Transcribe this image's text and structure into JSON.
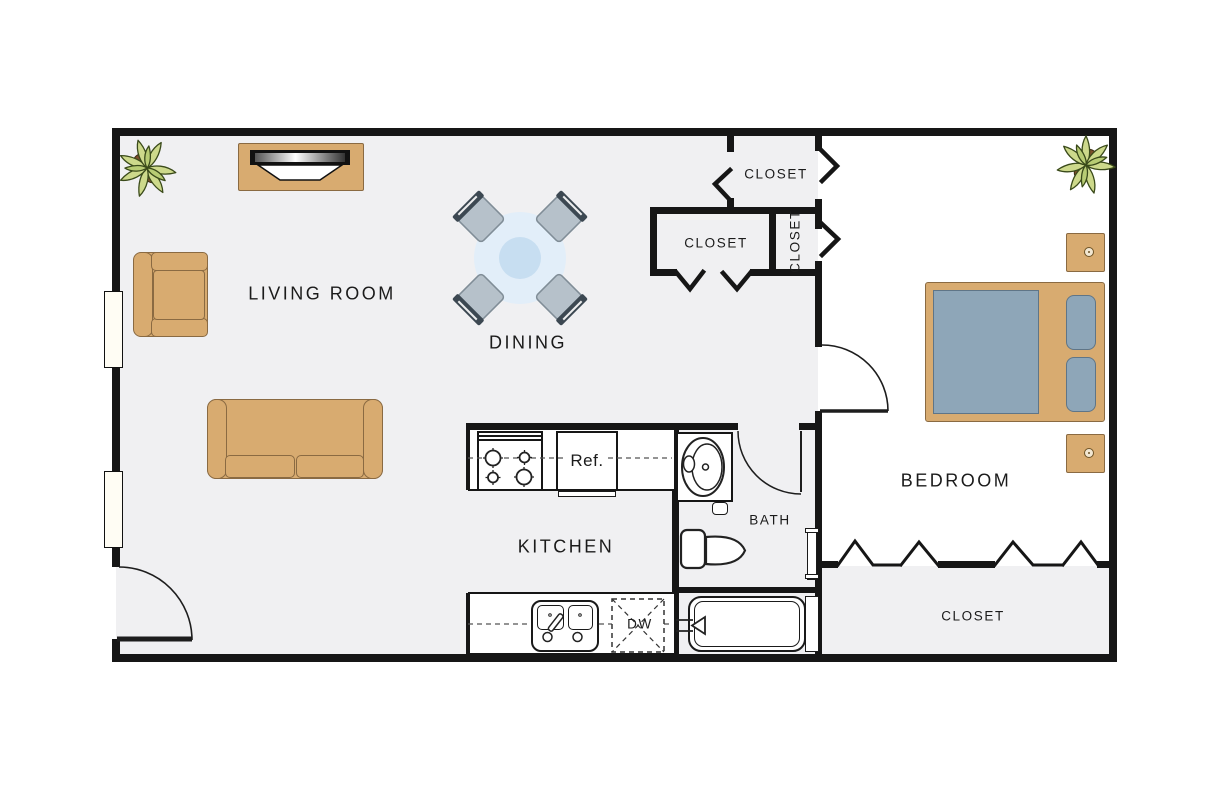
{
  "rooms": {
    "living_room": {
      "label": "LIVING ROOM"
    },
    "dining": {
      "label": "DINING"
    },
    "kitchen": {
      "label": "KITCHEN"
    },
    "bath": {
      "label": "BATH"
    },
    "bedroom": {
      "label": "BEDROOM"
    },
    "closet_top": {
      "label": "CLOSET"
    },
    "closet_hall": {
      "label": "CLOSET"
    },
    "closet_side": {
      "label": "CLOSET"
    },
    "closet_bedroom": {
      "label": "CLOSET"
    }
  },
  "appliances": {
    "refrigerator": {
      "label": "Ref."
    },
    "dishwasher": {
      "label": "DW"
    }
  },
  "colors": {
    "wall": "#161616",
    "floor": "#f0f0f2",
    "furn": "#d8ab70",
    "furn-border": "#8a6a42",
    "fabric": "#8ea6b8",
    "fabric-border": "#5f7587",
    "table": "#e2eef9",
    "table-inner": "#c7def1",
    "chair": "#b6c1ca",
    "chair-dark": "#3c4852",
    "plant": "#cdd98b",
    "plant-dark": "#3a4a1a",
    "window": "#fffdf4"
  }
}
